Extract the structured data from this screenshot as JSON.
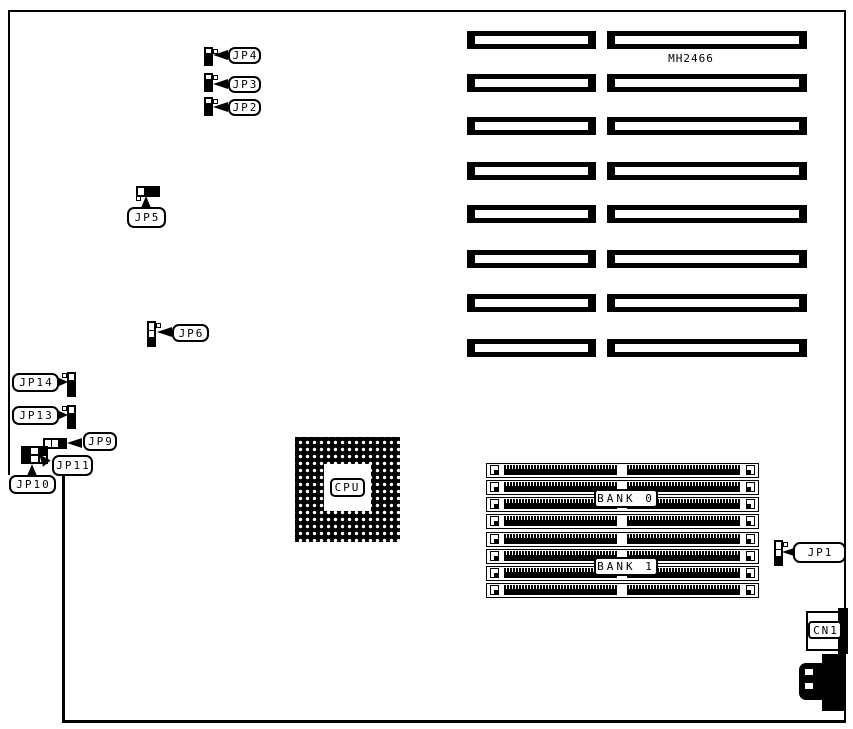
{
  "labels": {
    "model": "MH2466",
    "cpu": "CPU",
    "cn1": "CN1",
    "bank0": "BANK 0",
    "bank1": "BANK 1",
    "jp1": "JP1",
    "jp2": "JP2",
    "jp3": "JP3",
    "jp4": "JP4",
    "jp5": "JP5",
    "jp6": "JP6",
    "jp9": "JP9",
    "jp10": "JP10",
    "jp11": "JP11",
    "jp13": "JP13",
    "jp14": "JP14"
  },
  "components": {
    "expansion_slot_rows": 8,
    "expansion_slot_columns": 2,
    "memory_socket_count": 8,
    "memory_banks": [
      "BANK 0",
      "BANK 1"
    ]
  },
  "colors": {
    "foreground": "#000000",
    "background": "#ffffff"
  }
}
